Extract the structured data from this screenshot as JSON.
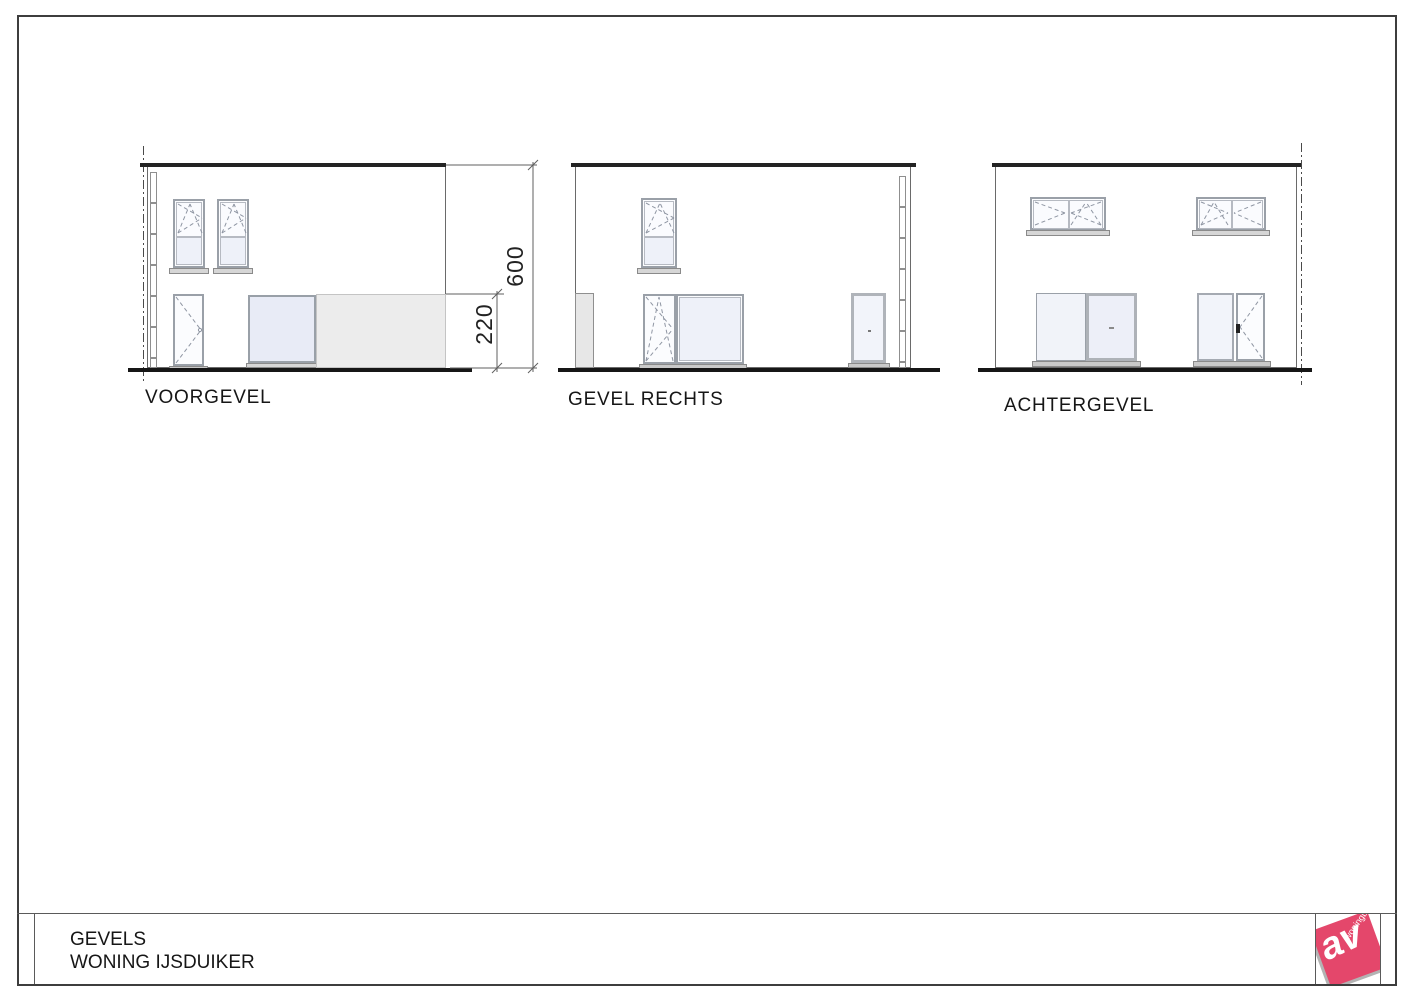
{
  "drawing": {
    "elevations": [
      {
        "id": "voorgevel",
        "label": "VOORGEVEL"
      },
      {
        "id": "gevel-rechts",
        "label": "GEVEL RECHTS"
      },
      {
        "id": "achtergevel",
        "label": "ACHTERGEVEL"
      }
    ],
    "dimensions": {
      "total_height": "600",
      "lower_height": "220"
    },
    "title_block": {
      "line1": "GEVELS",
      "line2": "WONING IJSDUIKER"
    },
    "logo": {
      "monogram": "av",
      "subtext": "woningbouw",
      "color": "#e4476b"
    }
  }
}
